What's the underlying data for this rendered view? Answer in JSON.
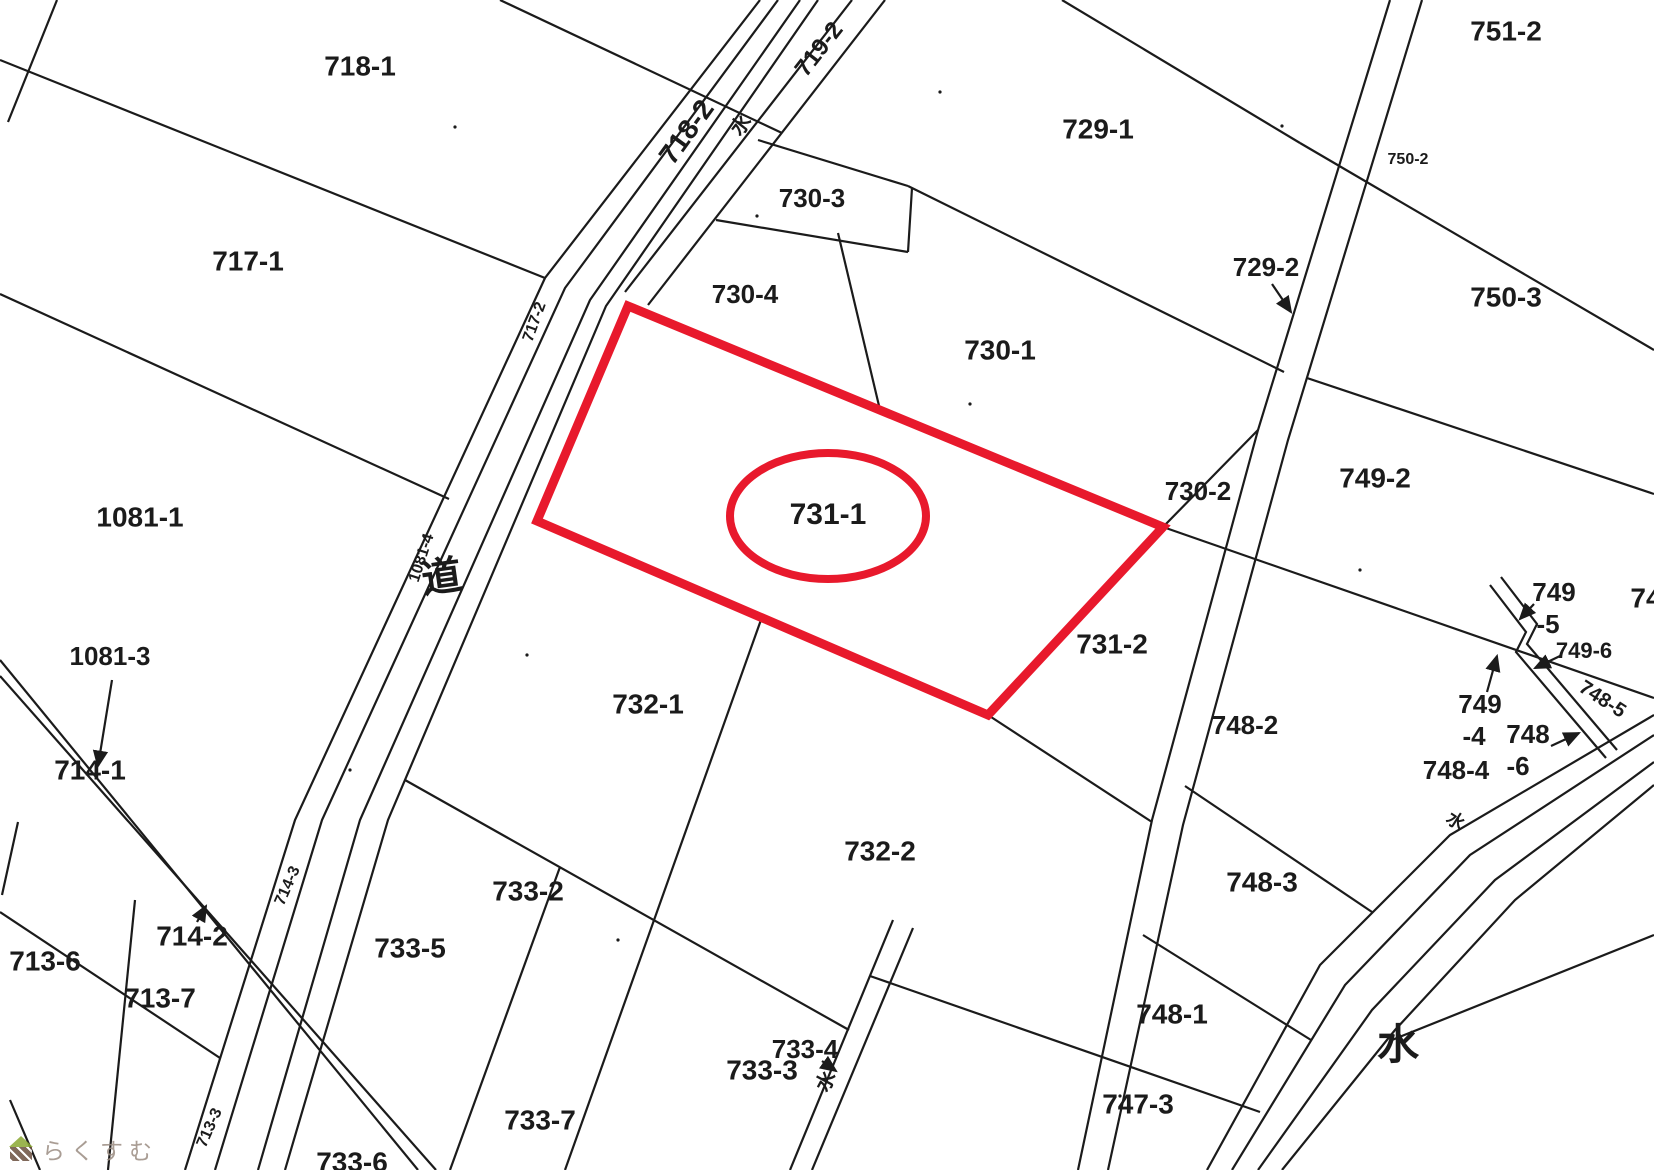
{
  "map": {
    "width": 1654,
    "height": 1170,
    "background": "#ffffff",
    "line_color": "#1b1b1b",
    "highlight_color": "#e8192c"
  },
  "highlight": {
    "parcel_id": "731-1",
    "polygon": [
      [
        628,
        306
      ],
      [
        1163,
        527
      ],
      [
        988,
        715
      ],
      [
        537,
        521
      ]
    ],
    "ellipse": {
      "cx": 828,
      "cy": 516,
      "rx": 98,
      "ry": 63
    },
    "stroke_width": 9
  },
  "parcel_labels": [
    {
      "text": "718-1",
      "x": 360,
      "y": 68,
      "size": 28,
      "rot": 0
    },
    {
      "text": "717-1",
      "x": 248,
      "y": 263,
      "size": 28,
      "rot": 0
    },
    {
      "text": "1081-1",
      "x": 140,
      "y": 519,
      "size": 28,
      "rot": 0
    },
    {
      "text": "1081-3",
      "x": 110,
      "y": 658,
      "size": 26,
      "rot": 0
    },
    {
      "text": "714-1",
      "x": 90,
      "y": 772,
      "size": 28,
      "rot": 0
    },
    {
      "text": "713-6",
      "x": 45,
      "y": 963,
      "size": 28,
      "rot": 0
    },
    {
      "text": "714-2",
      "x": 192,
      "y": 938,
      "size": 28,
      "rot": 0
    },
    {
      "text": "713-7",
      "x": 160,
      "y": 1000,
      "size": 28,
      "rot": 0
    },
    {
      "text": "729-1",
      "x": 1098,
      "y": 131,
      "size": 28,
      "rot": 0
    },
    {
      "text": "751-2",
      "x": 1506,
      "y": 33,
      "size": 28,
      "rot": 0
    },
    {
      "text": "750-2",
      "x": 1408,
      "y": 160,
      "size": 16,
      "rot": 0
    },
    {
      "text": "729-2",
      "x": 1266,
      "y": 269,
      "size": 26,
      "rot": 0
    },
    {
      "text": "750-3",
      "x": 1506,
      "y": 299,
      "size": 28,
      "rot": 0
    },
    {
      "text": "730-3",
      "x": 812,
      "y": 200,
      "size": 26,
      "rot": 0
    },
    {
      "text": "730-4",
      "x": 745,
      "y": 296,
      "size": 26,
      "rot": 0
    },
    {
      "text": "730-1",
      "x": 1000,
      "y": 352,
      "size": 28,
      "rot": 0
    },
    {
      "text": "730-2",
      "x": 1198,
      "y": 493,
      "size": 26,
      "rot": 0
    },
    {
      "text": "749-2",
      "x": 1375,
      "y": 480,
      "size": 28,
      "rot": 0
    },
    {
      "text": "731-1",
      "x": 828,
      "y": 516,
      "size": 30,
      "rot": 0
    },
    {
      "text": "731-2",
      "x": 1112,
      "y": 646,
      "size": 28,
      "rot": 0
    },
    {
      "text": "732-1",
      "x": 648,
      "y": 706,
      "size": 28,
      "rot": 0
    },
    {
      "text": "748-2",
      "x": 1245,
      "y": 727,
      "size": 26,
      "rot": 0
    },
    {
      "text": "733-2",
      "x": 528,
      "y": 893,
      "size": 28,
      "rot": 0
    },
    {
      "text": "732-2",
      "x": 880,
      "y": 853,
      "size": 28,
      "rot": 0
    },
    {
      "text": "733-5",
      "x": 410,
      "y": 950,
      "size": 28,
      "rot": 0
    },
    {
      "text": "748-3",
      "x": 1262,
      "y": 884,
      "size": 28,
      "rot": 0
    },
    {
      "text": "733-7",
      "x": 540,
      "y": 1122,
      "size": 28,
      "rot": 0
    },
    {
      "text": "733-3",
      "x": 762,
      "y": 1072,
      "size": 28,
      "rot": 0
    },
    {
      "text": "733-4",
      "x": 805,
      "y": 1051,
      "size": 26,
      "rot": 0
    },
    {
      "text": "748-1",
      "x": 1172,
      "y": 1016,
      "size": 28,
      "rot": 0
    },
    {
      "text": "747-3",
      "x": 1138,
      "y": 1106,
      "size": 28,
      "rot": 0
    },
    {
      "text": "733-6",
      "x": 352,
      "y": 1164,
      "size": 28,
      "rot": 0
    },
    {
      "text": "水",
      "x": 1398,
      "y": 1048,
      "size": 42,
      "rot": 0
    },
    {
      "text": "道",
      "x": 442,
      "y": 580,
      "size": 40,
      "rot": -8
    },
    {
      "text": "749",
      "x": 1554,
      "y": 594,
      "size": 26,
      "rot": 0
    },
    {
      "text": "-5",
      "x": 1548,
      "y": 626,
      "size": 26,
      "rot": 0
    },
    {
      "text": "749-6",
      "x": 1584,
      "y": 652,
      "size": 22,
      "rot": 0
    },
    {
      "text": "749",
      "x": 1480,
      "y": 706,
      "size": 26,
      "rot": 0
    },
    {
      "text": "-4",
      "x": 1474,
      "y": 738,
      "size": 26,
      "rot": 0
    },
    {
      "text": "748",
      "x": 1528,
      "y": 736,
      "size": 26,
      "rot": 0
    },
    {
      "text": "-6",
      "x": 1518,
      "y": 768,
      "size": 26,
      "rot": 0
    },
    {
      "text": "748-4",
      "x": 1456,
      "y": 772,
      "size": 26,
      "rot": 0
    },
    {
      "text": "748-5",
      "x": 1602,
      "y": 700,
      "size": 20,
      "rot": 33
    },
    {
      "text": "74",
      "x": 1646,
      "y": 600,
      "size": 28,
      "rot": 0
    },
    {
      "text": "717-2",
      "x": 535,
      "y": 322,
      "size": 16,
      "rot": -70
    },
    {
      "text": "1081-4",
      "x": 422,
      "y": 558,
      "size": 16,
      "rot": -72
    },
    {
      "text": "718-2",
      "x": 688,
      "y": 133,
      "size": 28,
      "rot": -54
    },
    {
      "text": "719-2",
      "x": 820,
      "y": 50,
      "size": 24,
      "rot": -52
    },
    {
      "text": "水",
      "x": 742,
      "y": 126,
      "size": 20,
      "rot": -52
    },
    {
      "text": "714-3",
      "x": 288,
      "y": 886,
      "size": 16,
      "rot": -66
    },
    {
      "text": "713-3",
      "x": 210,
      "y": 1128,
      "size": 16,
      "rot": -66
    },
    {
      "text": "水",
      "x": 827,
      "y": 1082,
      "size": 20,
      "rot": -62
    },
    {
      "text": "水",
      "x": 1455,
      "y": 822,
      "size": 18,
      "rot": 33
    }
  ],
  "map_lines": [
    {
      "name": "road-west-1",
      "pts": [
        [
          760,
          0
        ],
        [
          545,
          278
        ],
        [
          295,
          820
        ],
        [
          185,
          1170
        ]
      ]
    },
    {
      "name": "road-west-2",
      "pts": [
        [
          778,
          0
        ],
        [
          565,
          288
        ],
        [
          322,
          820
        ],
        [
          215,
          1170
        ]
      ]
    },
    {
      "name": "road-east-1",
      "pts": [
        [
          800,
          0
        ],
        [
          590,
          300
        ],
        [
          360,
          820
        ],
        [
          258,
          1170
        ]
      ]
    },
    {
      "name": "road-east-2",
      "pts": [
        [
          818,
          0
        ],
        [
          606,
          306
        ],
        [
          388,
          820
        ],
        [
          285,
          1170
        ]
      ]
    },
    {
      "name": "waterway-top-1",
      "pts": [
        [
          852,
          0
        ],
        [
          625,
          292
        ]
      ]
    },
    {
      "name": "waterway-top-2",
      "pts": [
        [
          885,
          0
        ],
        [
          648,
          305
        ]
      ]
    },
    {
      "name": "channel-right-1",
      "pts": [
        [
          1390,
          0
        ],
        [
          1258,
          430
        ],
        [
          1152,
          820
        ],
        [
          1078,
          1170
        ]
      ]
    },
    {
      "name": "channel-right-2",
      "pts": [
        [
          1422,
          0
        ],
        [
          1288,
          440
        ],
        [
          1183,
          825
        ],
        [
          1108,
          1170
        ]
      ]
    },
    {
      "name": "river-1",
      "pts": [
        [
          1654,
          715
        ],
        [
          1450,
          835
        ],
        [
          1320,
          965
        ],
        [
          1207,
          1170
        ]
      ]
    },
    {
      "name": "river-2",
      "pts": [
        [
          1654,
          735
        ],
        [
          1470,
          855
        ],
        [
          1345,
          985
        ],
        [
          1232,
          1170
        ]
      ]
    },
    {
      "name": "river-3",
      "pts": [
        [
          1654,
          762
        ],
        [
          1495,
          880
        ],
        [
          1372,
          1010
        ],
        [
          1258,
          1170
        ]
      ]
    },
    {
      "name": "river-4",
      "pts": [
        [
          1654,
          785
        ],
        [
          1515,
          900
        ],
        [
          1395,
          1030
        ],
        [
          1282,
          1170
        ]
      ]
    },
    {
      "name": "ditch-bottom-1",
      "pts": [
        [
          893,
          920
        ],
        [
          790,
          1170
        ]
      ]
    },
    {
      "name": "ditch-bottom-2",
      "pts": [
        [
          913,
          928
        ],
        [
          812,
          1170
        ]
      ]
    },
    {
      "name": "strip-1081-3-a",
      "pts": [
        [
          0,
          660
        ],
        [
          418,
          1170
        ]
      ]
    },
    {
      "name": "strip-1081-3-b",
      "pts": [
        [
          0,
          676
        ],
        [
          436,
          1170
        ]
      ]
    },
    {
      "name": "ditch-749-a",
      "pts": [
        [
          1490,
          585
        ],
        [
          1526,
          632
        ],
        [
          1516,
          652
        ],
        [
          1606,
          758
        ]
      ]
    },
    {
      "name": "ditch-749-b",
      "pts": [
        [
          1501,
          577
        ],
        [
          1537,
          624
        ],
        [
          1527,
          644
        ],
        [
          1617,
          750
        ]
      ]
    },
    {
      "name": "corner-top-left",
      "pts": [
        [
          57,
          0
        ],
        [
          8,
          122
        ]
      ]
    },
    {
      "name": "boundary",
      "pts": [
        [
          500,
          0
        ],
        [
          782,
          133
        ]
      ]
    },
    {
      "name": "boundary",
      "pts": [
        [
          0,
          60
        ],
        [
          545,
          278
        ]
      ]
    },
    {
      "name": "boundary",
      "pts": [
        [
          0,
          294
        ],
        [
          449,
          499
        ]
      ]
    },
    {
      "name": "boundary",
      "pts": [
        [
          0,
          912
        ],
        [
          220,
          1058
        ]
      ]
    },
    {
      "name": "boundary",
      "pts": [
        [
          135,
          900
        ],
        [
          108,
          1170
        ]
      ]
    },
    {
      "name": "boundary",
      "pts": [
        [
          1062,
          0
        ],
        [
          1300,
          143
        ]
      ]
    },
    {
      "name": "boundary",
      "pts": [
        [
          1300,
          143
        ],
        [
          1654,
          350
        ]
      ]
    },
    {
      "name": "boundary",
      "pts": [
        [
          758,
          140
        ],
        [
          908,
          186
        ]
      ]
    },
    {
      "name": "boundary",
      "pts": [
        [
          908,
          186
        ],
        [
          1284,
          372
        ]
      ]
    },
    {
      "name": "boundary",
      "pts": [
        [
          1307,
          378
        ],
        [
          1654,
          494
        ]
      ]
    },
    {
      "name": "boundary",
      "pts": [
        [
          716,
          220
        ],
        [
          908,
          252
        ]
      ]
    },
    {
      "name": "boundary",
      "pts": [
        [
          838,
          233
        ],
        [
          880,
          410
        ]
      ]
    },
    {
      "name": "boundary",
      "pts": [
        [
          908,
          252
        ],
        [
          912,
          188
        ]
      ]
    },
    {
      "name": "boundary",
      "pts": [
        [
          1163,
          527
        ],
        [
          1258,
          430
        ]
      ]
    },
    {
      "name": "boundary",
      "pts": [
        [
          1163,
          527
        ],
        [
          1654,
          698
        ]
      ]
    },
    {
      "name": "boundary",
      "pts": [
        [
          988,
          715
        ],
        [
          1152,
          822
        ]
      ]
    },
    {
      "name": "boundary",
      "pts": [
        [
          1185,
          786
        ],
        [
          1372,
          912
        ]
      ]
    },
    {
      "name": "boundary",
      "pts": [
        [
          1143,
          935
        ],
        [
          1311,
          1040
        ]
      ]
    },
    {
      "name": "boundary",
      "pts": [
        [
          870,
          976
        ],
        [
          1260,
          1112
        ]
      ]
    },
    {
      "name": "boundary",
      "pts": [
        [
          405,
          780
        ],
        [
          849,
          1030
        ]
      ]
    },
    {
      "name": "boundary",
      "pts": [
        [
          762,
          617
        ],
        [
          565,
          1170
        ]
      ]
    },
    {
      "name": "boundary",
      "pts": [
        [
          560,
          867
        ],
        [
          450,
          1170
        ]
      ]
    },
    {
      "name": "boundary",
      "pts": [
        [
          1392,
          1040
        ],
        [
          1654,
          935
        ]
      ]
    },
    {
      "name": "boundary",
      "pts": [
        [
          18,
          822
        ],
        [
          2,
          895
        ]
      ]
    },
    {
      "name": "boundary",
      "pts": [
        [
          10,
          1100
        ],
        [
          40,
          1170
        ]
      ]
    }
  ],
  "arrows": [
    {
      "label": "1081-3",
      "x1": 112,
      "y1": 680,
      "x2": 98,
      "y2": 766
    },
    {
      "label": "714-2",
      "x1": 197,
      "y1": 922,
      "x2": 206,
      "y2": 906
    },
    {
      "label": "729-2",
      "x1": 1272,
      "y1": 284,
      "x2": 1291,
      "y2": 312
    },
    {
      "label": "733-4",
      "x1": 822,
      "y1": 1061,
      "x2": 836,
      "y2": 1071
    },
    {
      "label": "749-5",
      "x1": 1534,
      "y1": 604,
      "x2": 1520,
      "y2": 619
    },
    {
      "label": "749-6",
      "x1": 1560,
      "y1": 656,
      "x2": 1535,
      "y2": 668
    },
    {
      "label": "749-4",
      "x1": 1487,
      "y1": 692,
      "x2": 1497,
      "y2": 656
    },
    {
      "label": "748-6",
      "x1": 1551,
      "y1": 746,
      "x2": 1579,
      "y2": 733
    }
  ],
  "dots": [
    [
      455,
      127
    ],
    [
      940,
      92
    ],
    [
      1282,
      126
    ],
    [
      970,
      404
    ],
    [
      1360,
      570
    ],
    [
      527,
      655
    ],
    [
      350,
      770
    ],
    [
      757,
      216
    ],
    [
      1120,
      1096
    ],
    [
      618,
      940
    ]
  ],
  "watermark": {
    "text": "らくすむ",
    "icon": "house-icon",
    "text_color": "#9b8c82",
    "roof_color": "#8aa832",
    "body_color": "#6b4f3f"
  }
}
